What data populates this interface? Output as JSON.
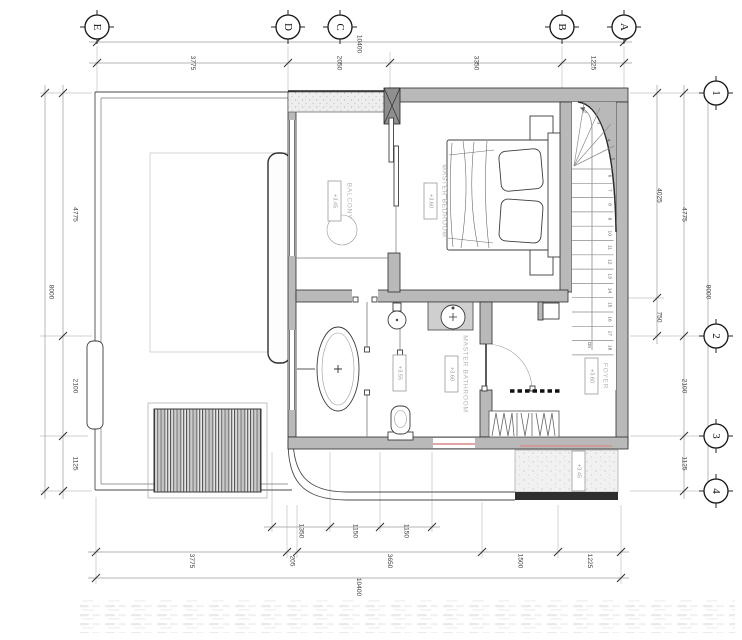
{
  "grid": {
    "top_letters": [
      "E",
      "D",
      "C",
      "B",
      "A"
    ],
    "right_numbers": [
      "1",
      "2",
      "3",
      "4"
    ]
  },
  "dimensions": {
    "top_overall": [
      "10400"
    ],
    "top_chain": [
      "3775",
      "2050",
      "3350",
      "1225"
    ],
    "left_inner": [
      "4775",
      "2100",
      "1125"
    ],
    "left_outer": [
      "8000"
    ],
    "right_inner": [
      "4025",
      "750"
    ],
    "right_middle": [
      "4775",
      "2100",
      "1125"
    ],
    "right_outer": [
      "8000"
    ],
    "bottom_inner": [
      "1350",
      "1150",
      "1150"
    ],
    "bottom_middle": [
      "3775",
      "205",
      "3650",
      "1500",
      "1225"
    ],
    "bottom_outer": [
      "10400"
    ]
  },
  "rooms": [
    {
      "name": "MASTER BEDROOM",
      "level": "+3.60"
    },
    {
      "name": "BALCONY",
      "level": "+3.45"
    },
    {
      "name": "MASTER BATHROOM",
      "level": "+3.60"
    },
    {
      "name": "FOYER",
      "level": "+3.60"
    }
  ],
  "levels": {
    "bath_floor": "+3.55",
    "ledge": "+3.45"
  },
  "stairs": {
    "numbers": [
      "2",
      "3",
      "4",
      "5",
      "6",
      "7",
      "8",
      "9",
      "10",
      "11",
      "12",
      "13",
      "14",
      "15",
      "16",
      "17",
      "18"
    ],
    "direction_label": "Dn"
  },
  "colors": {
    "wall_fill": "#b9b9b9",
    "line": "#2b2b2b",
    "grid_line": "#c3c3c3",
    "dim_text": "#3f3f3f",
    "label_text": "#b5b5b5",
    "accent_red": "#d98a85",
    "stipple": "#ececec"
  }
}
